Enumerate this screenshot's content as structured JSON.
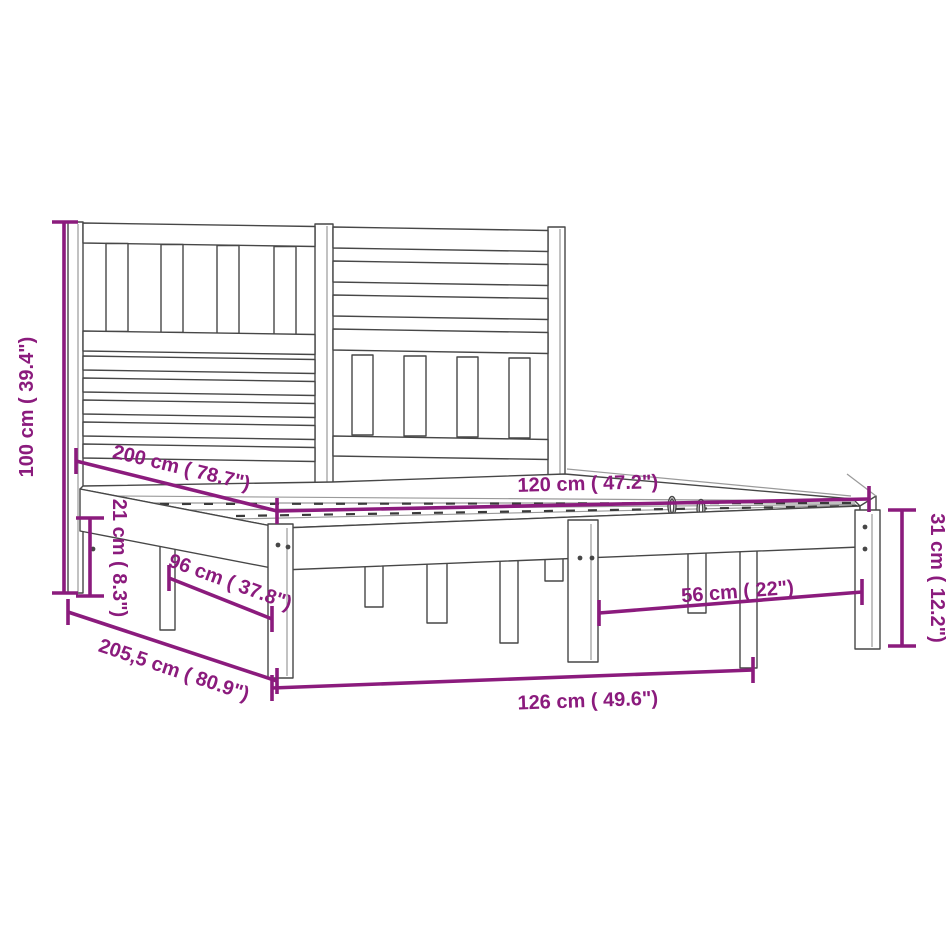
{
  "title": "Bed frame with headboard - dimension diagram",
  "colors": {
    "accent": "#8b1b7d",
    "line": "#474747",
    "background": "#ffffff"
  },
  "dimensions": {
    "height_total": {
      "label": "100 cm ( 39.4\")"
    },
    "length_bed": {
      "label": "200 cm ( 78.7\")"
    },
    "width_bed": {
      "label": "120 cm ( 47.2\")"
    },
    "clearance": {
      "label": "21 cm ( 8.3\")"
    },
    "leg_span_side": {
      "label": "96 cm ( 37.8\")"
    },
    "length_total": {
      "label": "205,5 cm ( 80.9\")"
    },
    "width_total": {
      "label": "126 cm ( 49.6\")"
    },
    "leg_span_end": {
      "label": "56 cm ( 22\")"
    },
    "base_height": {
      "label": "31 cm ( 12.2\")"
    }
  }
}
